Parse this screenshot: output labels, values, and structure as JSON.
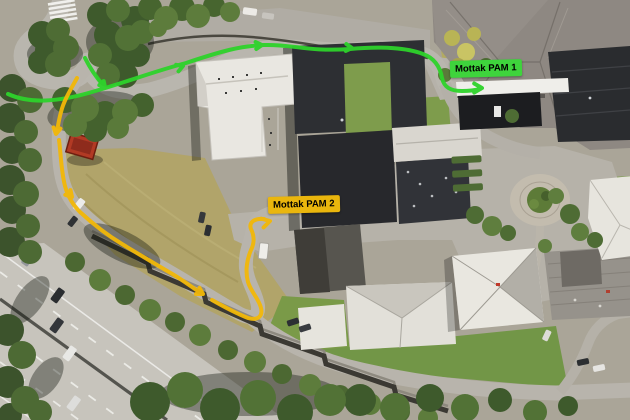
{
  "annotations": {
    "labels": [
      {
        "text": "Mottak PAM 1",
        "bg_color": "#3ed43c",
        "text_color": "#000000"
      },
      {
        "text": "Mottak PAM 2",
        "bg_color": "#eab60d",
        "text_color": "#000000"
      }
    ],
    "routes": [
      {
        "name": "green-route",
        "color": "#2ed32b"
      },
      {
        "name": "yellow-route",
        "color": "#f2b808"
      }
    ]
  }
}
